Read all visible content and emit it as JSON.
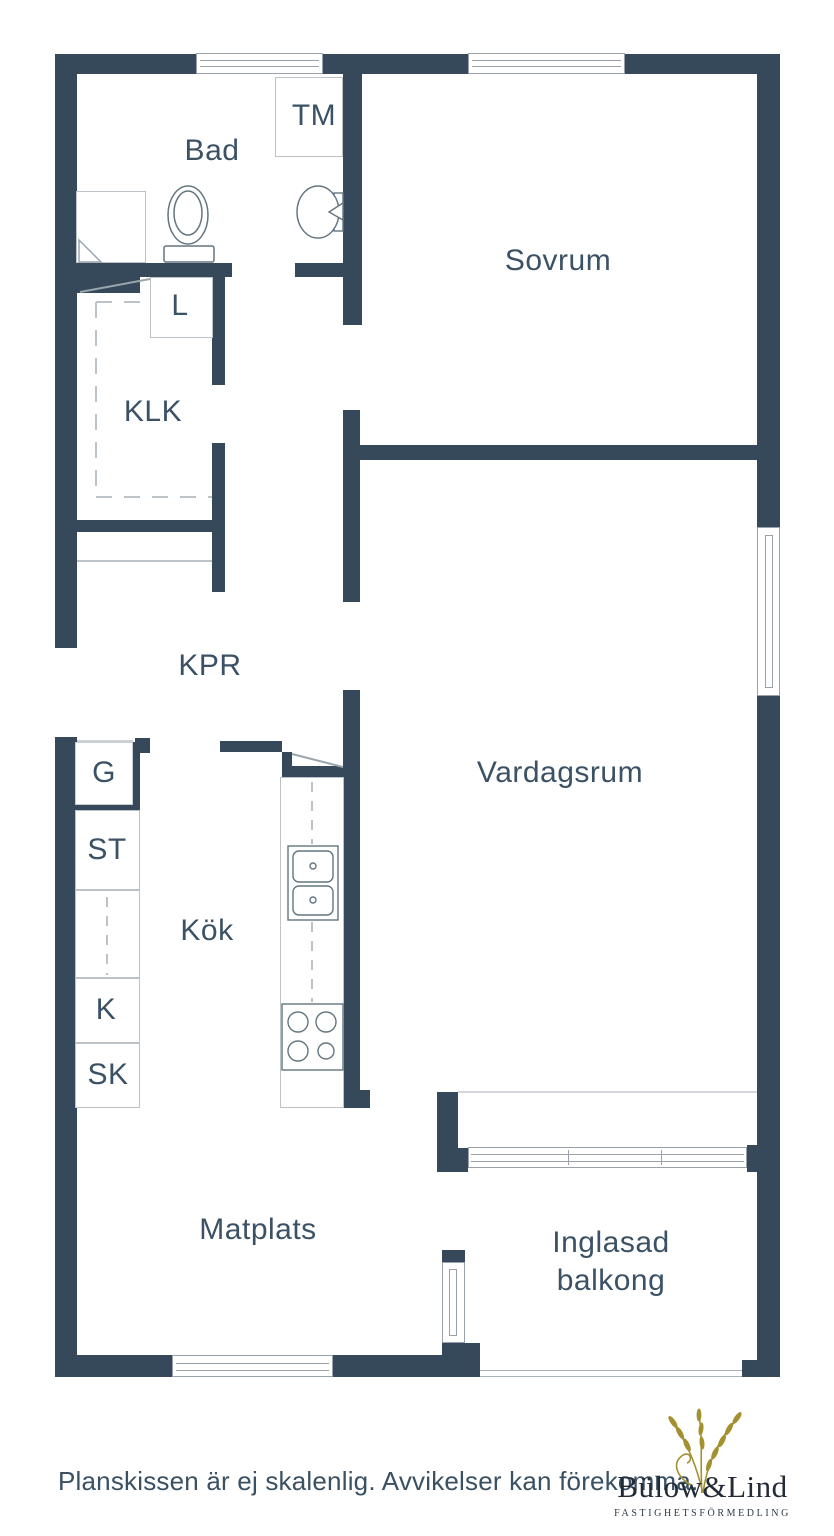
{
  "plan": {
    "labels": {
      "bathroom": "Bad",
      "washing_machine": "TM",
      "bedroom": "Sovrum",
      "linen_closet": "L",
      "walk_in_closet": "KLK",
      "hallway": "KPR",
      "fridge": "G",
      "st_cabinet": "ST",
      "kitchen": "Kök",
      "k_cabinet": "K",
      "sk_cabinet": "SK",
      "living_room": "Vardagsrum",
      "dining": "Matplats",
      "balcony_line1": "Inglasad",
      "balcony_line2": "balkong"
    },
    "colors": {
      "wall": "#36495a",
      "label_text": "#3b5165",
      "fixture_line": "#63757f",
      "light_line": "#bcc3c8",
      "window_line": "#99a2aa",
      "logo_gold": "#a3902f",
      "logo_text": "#222b36"
    }
  },
  "footer": {
    "disclaimer": "Planskissen är ej skalenlig. Avvikelser kan förekomma.",
    "brand": "Bülow&Lind",
    "tagline": "FASTIGHETSFÖRMEDLING"
  }
}
